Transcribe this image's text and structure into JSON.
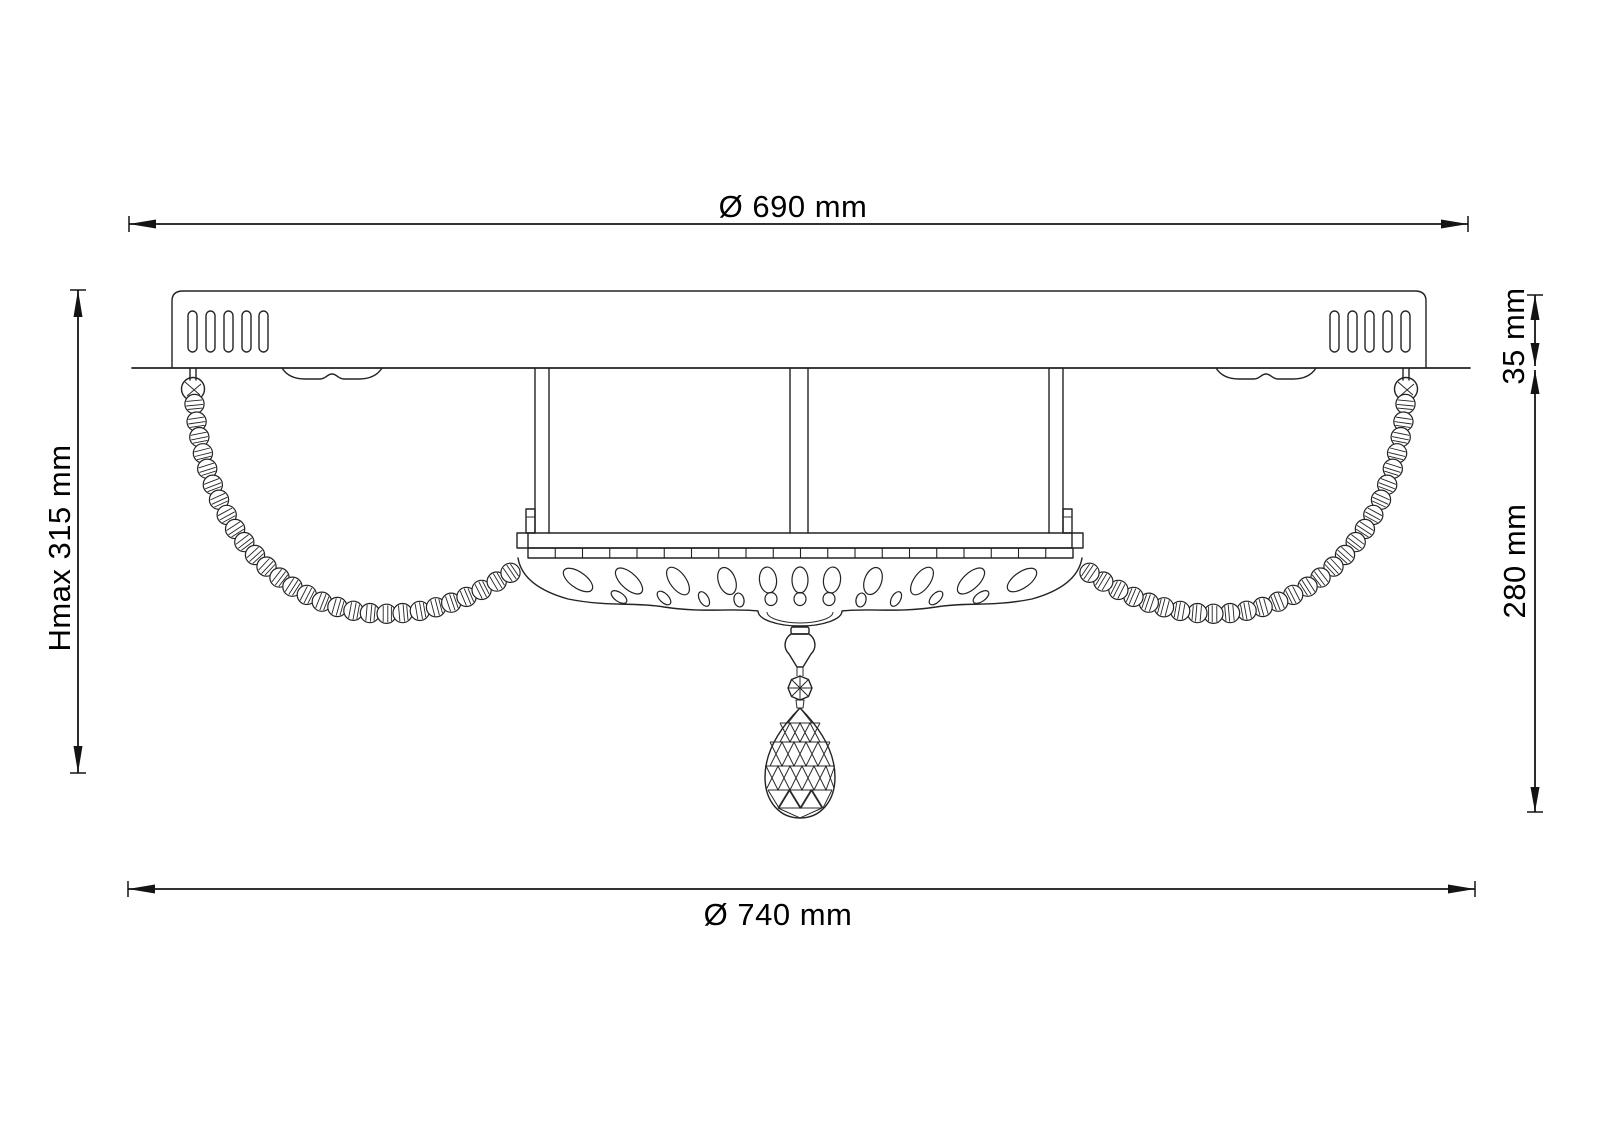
{
  "drawing": {
    "title": "Ceiling light technical dimension drawing",
    "line_color": "#232323",
    "dimension_color": "#141414",
    "background": "#ffffff"
  },
  "dimensions": {
    "top_diameter": "Ø 690 mm",
    "bottom_diameter": "Ø 740 mm",
    "max_height": "Hmax 315 mm",
    "canopy_height": "35 mm",
    "body_drop": "280 mm"
  }
}
